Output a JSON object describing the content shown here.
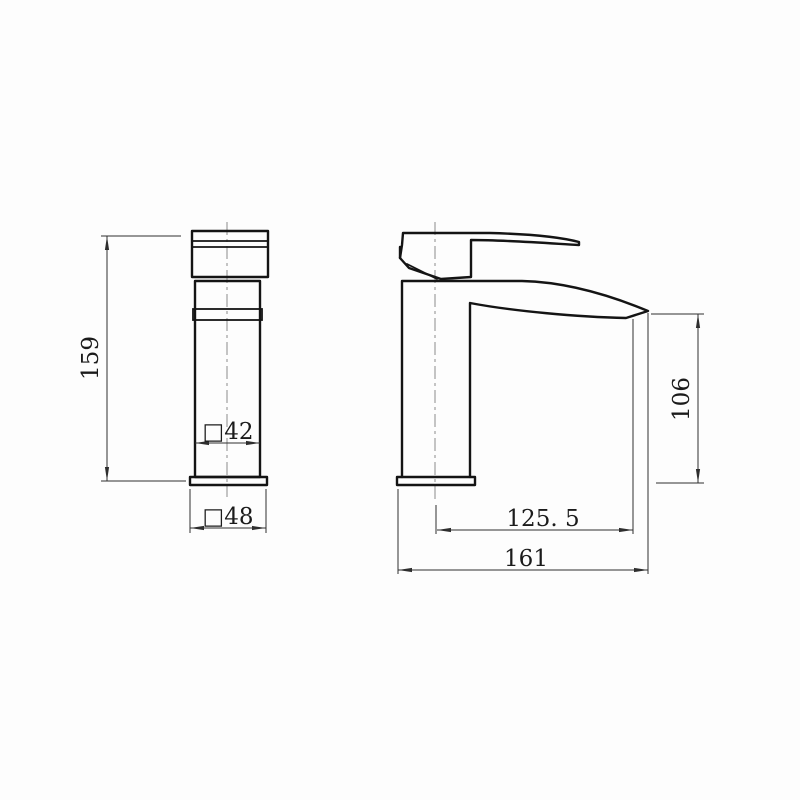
{
  "drawing": {
    "kind": "technical-dimension-drawing",
    "subject": "single-lever basin mixer tap, front and side orthographic views",
    "background_color": "#fdfdfd",
    "line_color": "#141414",
    "dimension_color": "#2e2e2e",
    "centerline_color": "#8a8a8a"
  },
  "dimensions": {
    "front_height": "159",
    "front_body_width": "□42",
    "front_base_width": "□48",
    "side_spout_height": "106",
    "side_spout_reach": "125. 5",
    "side_total_depth": "161"
  }
}
